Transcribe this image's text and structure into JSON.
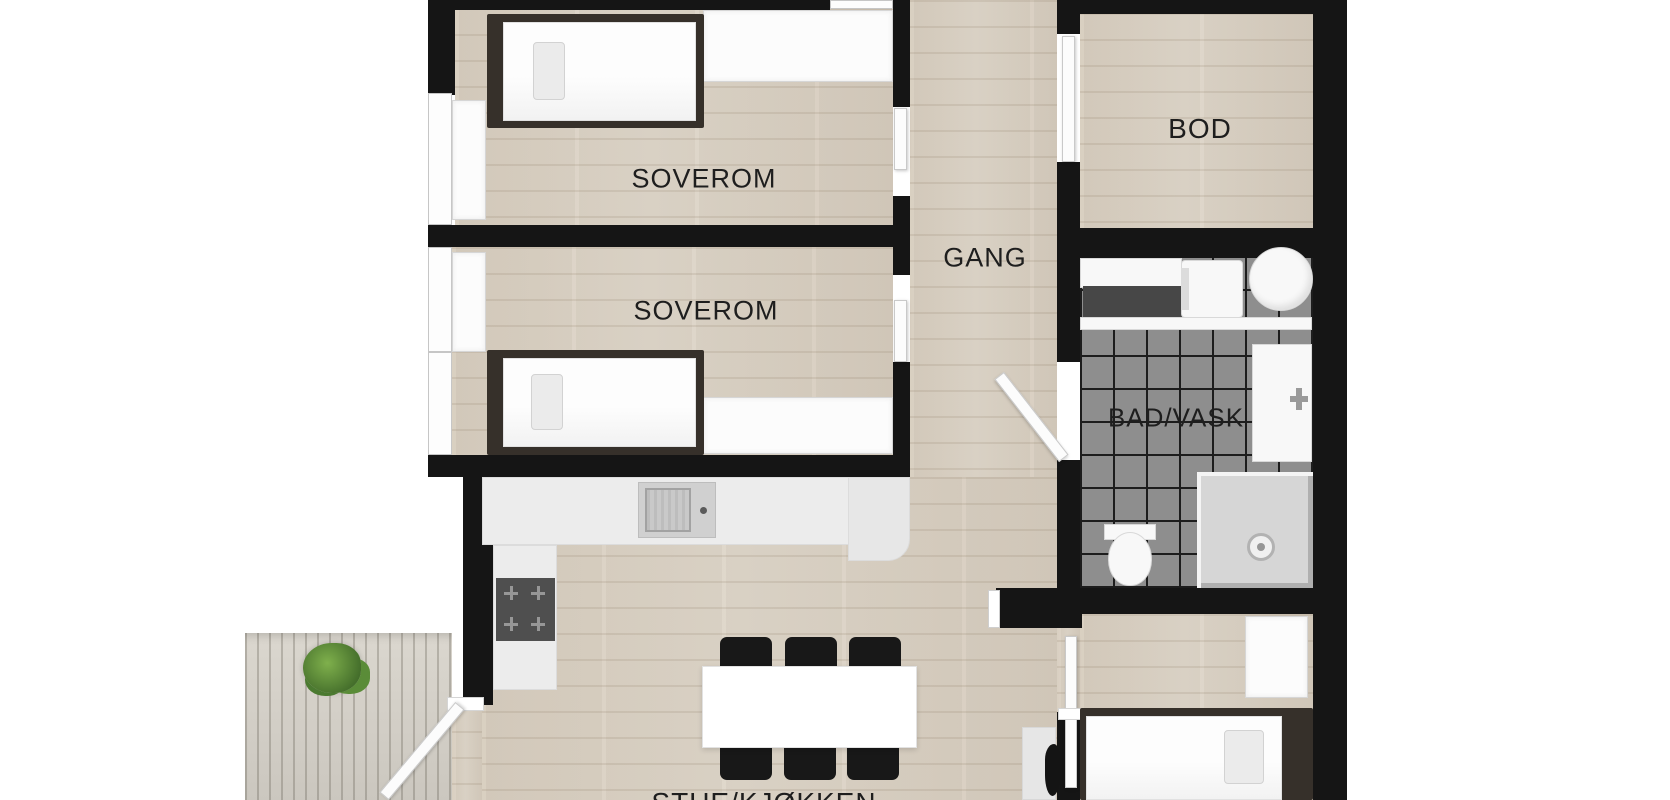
{
  "plan_type": "floorplan-top-view",
  "rooms": [
    {
      "key": "soverom-1",
      "label": "SOVEROM"
    },
    {
      "key": "soverom-2",
      "label": "SOVEROM"
    },
    {
      "key": "gang",
      "label": "GANG"
    },
    {
      "key": "bod",
      "label": "BOD"
    },
    {
      "key": "bad-vask",
      "label": "BAD/VASK"
    },
    {
      "key": "stue-kjokken",
      "label": "STUE/KJØKKEN"
    }
  ],
  "colors": {
    "wall": "#151515",
    "wood_floor": "#d9d0c2",
    "deck_wood": "#d4d0c8",
    "bathroom_tile": "#8e8e8e",
    "tile_grout": "#1d1d1d",
    "furniture_dark": "#36302a",
    "chair_black": "#181818",
    "stove": "#4f4f4f",
    "plant_green": "#4b7a30",
    "label_text": "#1e1e1e"
  }
}
